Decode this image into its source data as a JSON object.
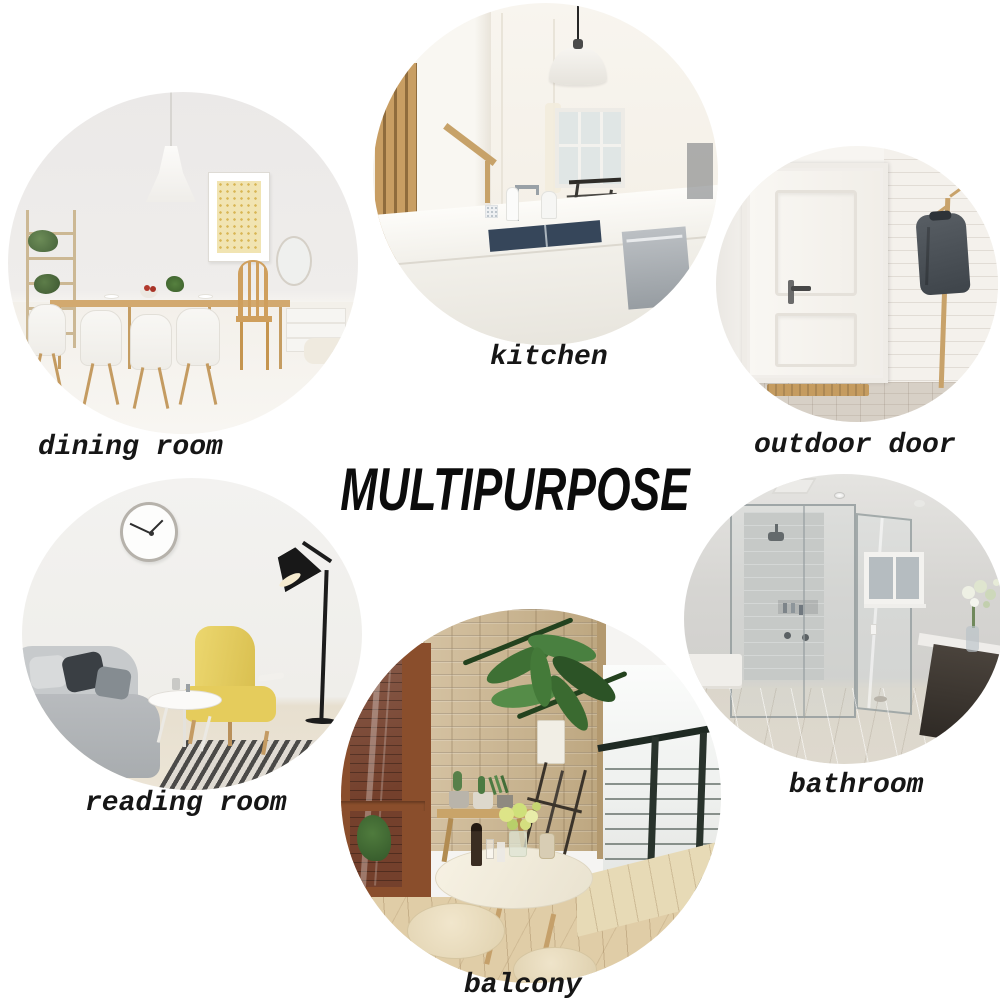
{
  "title": "MULTIPURPOSE",
  "text_color": "#161616",
  "background_color": "#ffffff",
  "scenes": [
    {
      "id": "dining-room",
      "label": "dining room",
      "alt": "bright dining room with pendant lamp, gold wall art, ladder shelf with plants, wooden table and white chairs"
    },
    {
      "id": "kitchen",
      "label": "kitchen",
      "alt": "white kitchen island with dark sink, faucet, pendant dome lamp, wooden stair slats and window"
    },
    {
      "id": "outdoor-door",
      "label": "outdoor door",
      "alt": "white paneled front door with handle, brick wall, wooden coat rack with grey jacket and doormat"
    },
    {
      "id": "reading-room",
      "label": "reading room",
      "alt": "reading corner with wall clock, black floor lamp, yellow wingback armchair, grey sofa, round side table and striped rug"
    },
    {
      "id": "bathroom",
      "label": "bathroom",
      "alt": "glass walk-in shower, small window, dark vanity with white counter and flower bouquet"
    },
    {
      "id": "balcony",
      "label": "balcony",
      "alt": "balcony with stone wall, glass door, metal cable railing, tall potted plant, round table with flowers and cream stools"
    }
  ]
}
